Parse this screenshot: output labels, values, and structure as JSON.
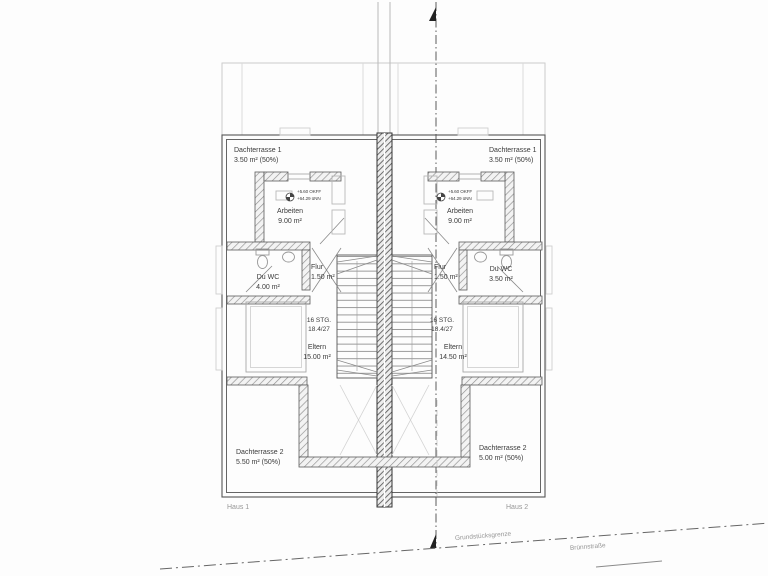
{
  "houses": {
    "left": {
      "name": "Haus 1",
      "roof_terrace_1": {
        "label": "Dachterrasse 1",
        "area": "3.50 m² (50%)"
      },
      "roof_terrace_2": {
        "label": "Dachterrasse 2",
        "area": "5.50 m² (50%)"
      },
      "rooms": {
        "arbeiten": {
          "label": "Arbeiten",
          "area": "9.00 m²"
        },
        "du_wc": {
          "label": "Du WC",
          "area": "4.00 m²"
        },
        "flur": {
          "label": "Flur",
          "area": "1.50 m²"
        },
        "eltern": {
          "label": "Eltern",
          "area": "15.00 m²"
        }
      },
      "stairs": {
        "line1": "16 STG.",
        "line2": "18.4/27"
      },
      "level_marker": {
        "line1": "+5.60 OKFF",
        "line2": "+64.29 üNN"
      }
    },
    "right": {
      "name": "Haus 2",
      "roof_terrace_1": {
        "label": "Dachterrasse 1",
        "area": "3.50 m² (50%)"
      },
      "roof_terrace_2": {
        "label": "Dachterrasse 2",
        "area": "5.00 m² (50%)"
      },
      "rooms": {
        "arbeiten": {
          "label": "Arbeiten",
          "area": "9.00 m²"
        },
        "du_wc": {
          "label": "Du WC",
          "area": "3.50 m²"
        },
        "flur": {
          "label": "Flur",
          "area": "1.50 m²"
        },
        "eltern": {
          "label": "Eltern",
          "area": "14.50 m²"
        }
      },
      "stairs": {
        "line1": "16 STG.",
        "line2": "18.4/27"
      },
      "level_marker": {
        "line1": "+5.60 OKFF",
        "line2": "+64.29 üNN"
      }
    }
  },
  "site": {
    "boundary_label": "Grundstücksgrenze",
    "street_label": "Brünnstraße"
  },
  "colors": {
    "wall_line": "#555555",
    "hatch": "#8f8f8f",
    "party_wall_hatch": "#4e4e4e",
    "faint_line": "#cccccc",
    "text": "#3a3a3a",
    "muted_text": "#979797"
  }
}
